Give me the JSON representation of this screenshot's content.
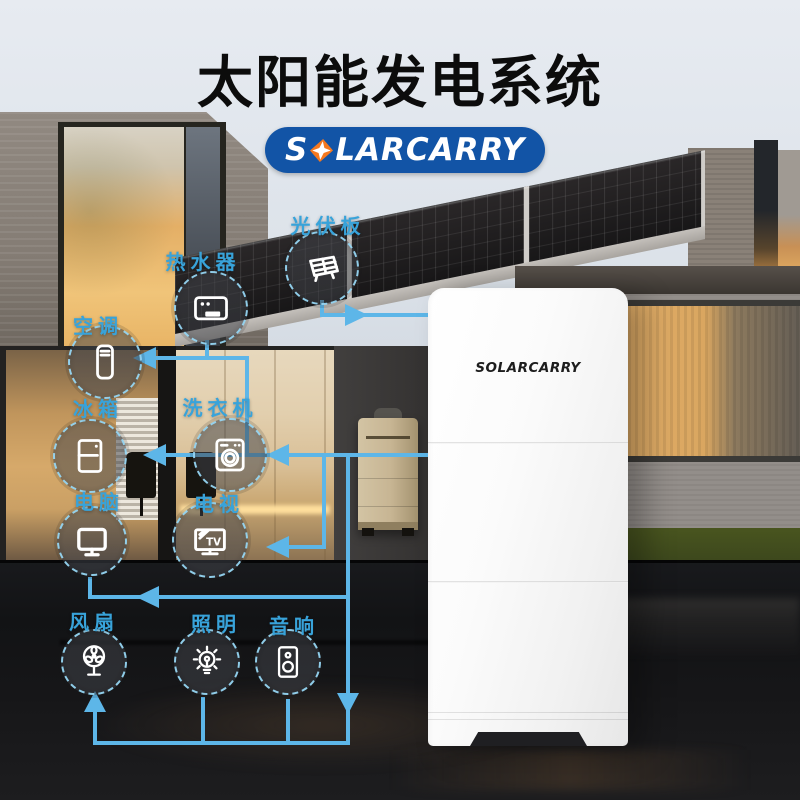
{
  "page": {
    "title": "太阳能发电系统"
  },
  "brand": {
    "name": "SOLARCARRY",
    "logo_prefix": "S",
    "logo_suffix": "LARCARRY"
  },
  "product": {
    "panel_brand": "SOLARCARRY"
  },
  "nodes": [
    {
      "id": "solar-panel",
      "label": "光伏板"
    },
    {
      "id": "water-heater",
      "label": "热水器"
    },
    {
      "id": "air-conditioner",
      "label": "空调"
    },
    {
      "id": "fridge",
      "label": "冰箱"
    },
    {
      "id": "washer",
      "label": "洗衣机"
    },
    {
      "id": "computer",
      "label": "电脑"
    },
    {
      "id": "tv",
      "label": "电视",
      "icon_text": "TV"
    },
    {
      "id": "fan",
      "label": "风扇"
    },
    {
      "id": "lighting",
      "label": "照明"
    },
    {
      "id": "audio",
      "label": "音响"
    }
  ],
  "colors": {
    "accent_line": "#5db6e8",
    "label_text": "#38a3da",
    "badge_bg": "#1254a6",
    "badge_diamond": "#f4781f",
    "title_text": "#0c0c0c"
  }
}
